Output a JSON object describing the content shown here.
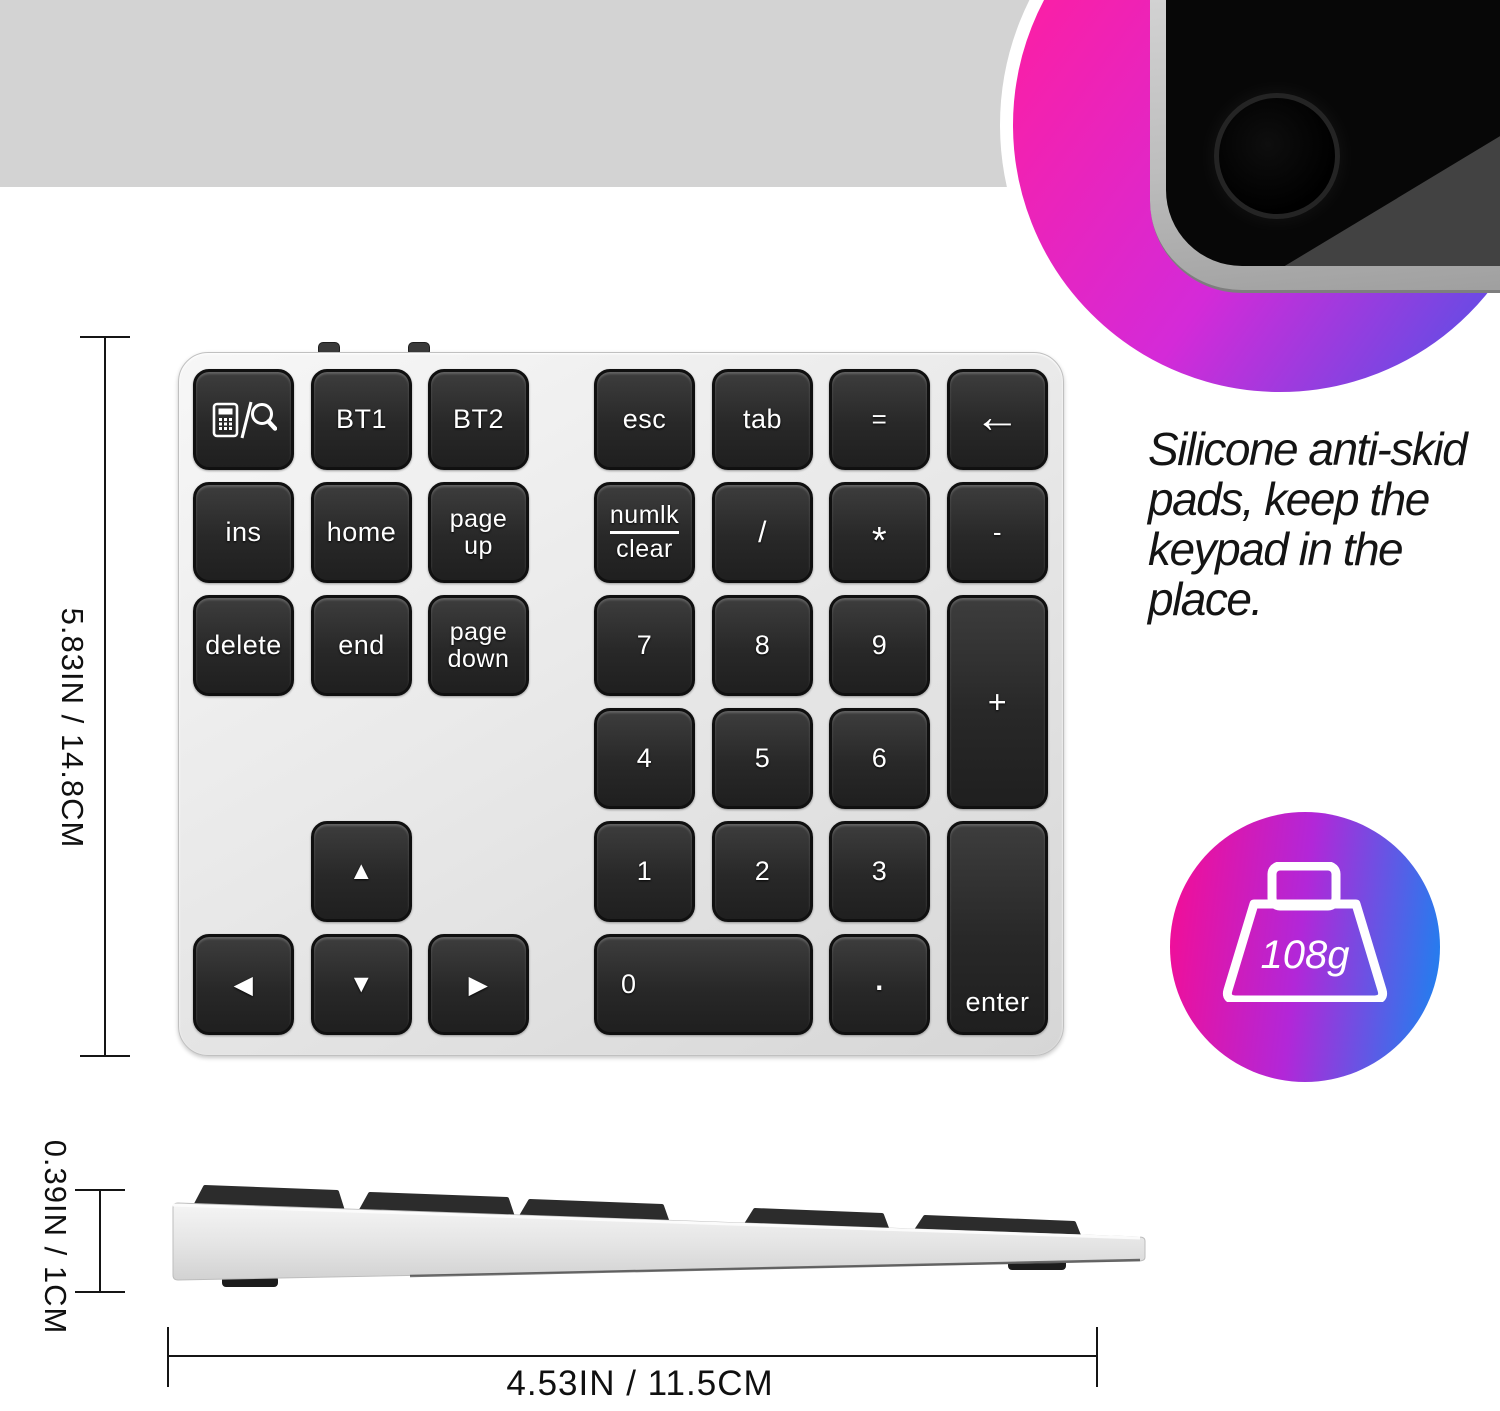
{
  "banner": {
    "bg": "#d3d3d3",
    "title": "Slim, Portable Desing",
    "title_gradient": [
      "#f75c8e",
      "#ec3bc6",
      "#a645e2",
      "#7a57ec",
      "#2b9bf5"
    ]
  },
  "hero": {
    "circle_gradient": [
      "#fb1fa5",
      "#d42ad8",
      "#4456e8"
    ],
    "tablet": {
      "screen_color": "#070707",
      "camera_icon": "camera-lens-icon"
    }
  },
  "feature": {
    "text": "Silicone anti-skid\npads, keep the\nkeypad in the\nplace."
  },
  "badge": {
    "value": "108g",
    "gradient": [
      "#ef0f9a",
      "#b227d8",
      "#1f80ef"
    ],
    "icon": "weight-icon"
  },
  "dimensions": {
    "height": "5.83IN / 14.8CM",
    "thickness": "0.39IN / 1CM",
    "width": "4.53IN / 11.5CM"
  },
  "keypad": {
    "keys": [
      {
        "id": "calc-search",
        "icon": "calculator-search",
        "col": 1,
        "row": 1
      },
      {
        "id": "bt1",
        "label": "BT1",
        "col": 2,
        "row": 1
      },
      {
        "id": "bt2",
        "label": "BT2",
        "col": 3,
        "row": 1
      },
      {
        "id": "esc",
        "label": "esc",
        "col": 4,
        "row": 1
      },
      {
        "id": "tab",
        "label": "tab",
        "col": 5,
        "row": 1
      },
      {
        "id": "equals",
        "label": "=",
        "col": 6,
        "row": 1
      },
      {
        "id": "backspace",
        "glyph": "←",
        "icon_name": "backspace-arrow-icon",
        "col": 7,
        "row": 1
      },
      {
        "id": "ins",
        "label": "ins",
        "col": 1,
        "row": 2
      },
      {
        "id": "home",
        "label": "home",
        "col": 2,
        "row": 2
      },
      {
        "id": "page-up",
        "lines": [
          "page",
          "up"
        ],
        "col": 3,
        "row": 2
      },
      {
        "id": "numlk-clear",
        "lines": [
          "numlk",
          "clear"
        ],
        "underline_first": true,
        "col": 4,
        "row": 2
      },
      {
        "id": "divide",
        "label": "/",
        "col": 5,
        "row": 2
      },
      {
        "id": "multiply",
        "label": "*",
        "col": 6,
        "row": 2
      },
      {
        "id": "minus",
        "label": "-",
        "col": 7,
        "row": 2
      },
      {
        "id": "delete",
        "label": "delete",
        "col": 1,
        "row": 3
      },
      {
        "id": "end",
        "label": "end",
        "col": 2,
        "row": 3
      },
      {
        "id": "page-down",
        "lines": [
          "page",
          "down"
        ],
        "col": 3,
        "row": 3
      },
      {
        "id": "num7",
        "label": "7",
        "col": 4,
        "row": 3
      },
      {
        "id": "num8",
        "label": "8",
        "col": 5,
        "row": 3
      },
      {
        "id": "num9",
        "label": "9",
        "col": 6,
        "row": 3
      },
      {
        "id": "plus",
        "label": "+",
        "col": 7,
        "row": 3,
        "rowspan": 2
      },
      {
        "id": "num4",
        "label": "4",
        "col": 4,
        "row": 4
      },
      {
        "id": "num5",
        "label": "5",
        "col": 5,
        "row": 4
      },
      {
        "id": "num6",
        "label": "6",
        "col": 6,
        "row": 4
      },
      {
        "id": "arrow-up",
        "glyph": "▲",
        "icon_name": "up-arrow-icon",
        "col": 2,
        "row": 5
      },
      {
        "id": "num1",
        "label": "1",
        "col": 4,
        "row": 5
      },
      {
        "id": "num2",
        "label": "2",
        "col": 5,
        "row": 5
      },
      {
        "id": "num3",
        "label": "3",
        "col": 6,
        "row": 5
      },
      {
        "id": "enter",
        "label": "enter",
        "col": 7,
        "row": 5,
        "rowspan": 2
      },
      {
        "id": "arrow-left",
        "glyph": "◀",
        "icon_name": "left-arrow-icon",
        "col": 1,
        "row": 6
      },
      {
        "id": "arrow-down",
        "glyph": "▼",
        "icon_name": "down-arrow-icon",
        "col": 2,
        "row": 6
      },
      {
        "id": "arrow-right",
        "glyph": "▶",
        "icon_name": "right-arrow-icon",
        "col": 3,
        "row": 6
      },
      {
        "id": "num0",
        "label": "0",
        "col": 4,
        "row": 6,
        "colspan": 2
      },
      {
        "id": "decimal",
        "glyph": "·",
        "icon_name": "decimal-dot",
        "col": 6,
        "row": 6
      }
    ]
  }
}
